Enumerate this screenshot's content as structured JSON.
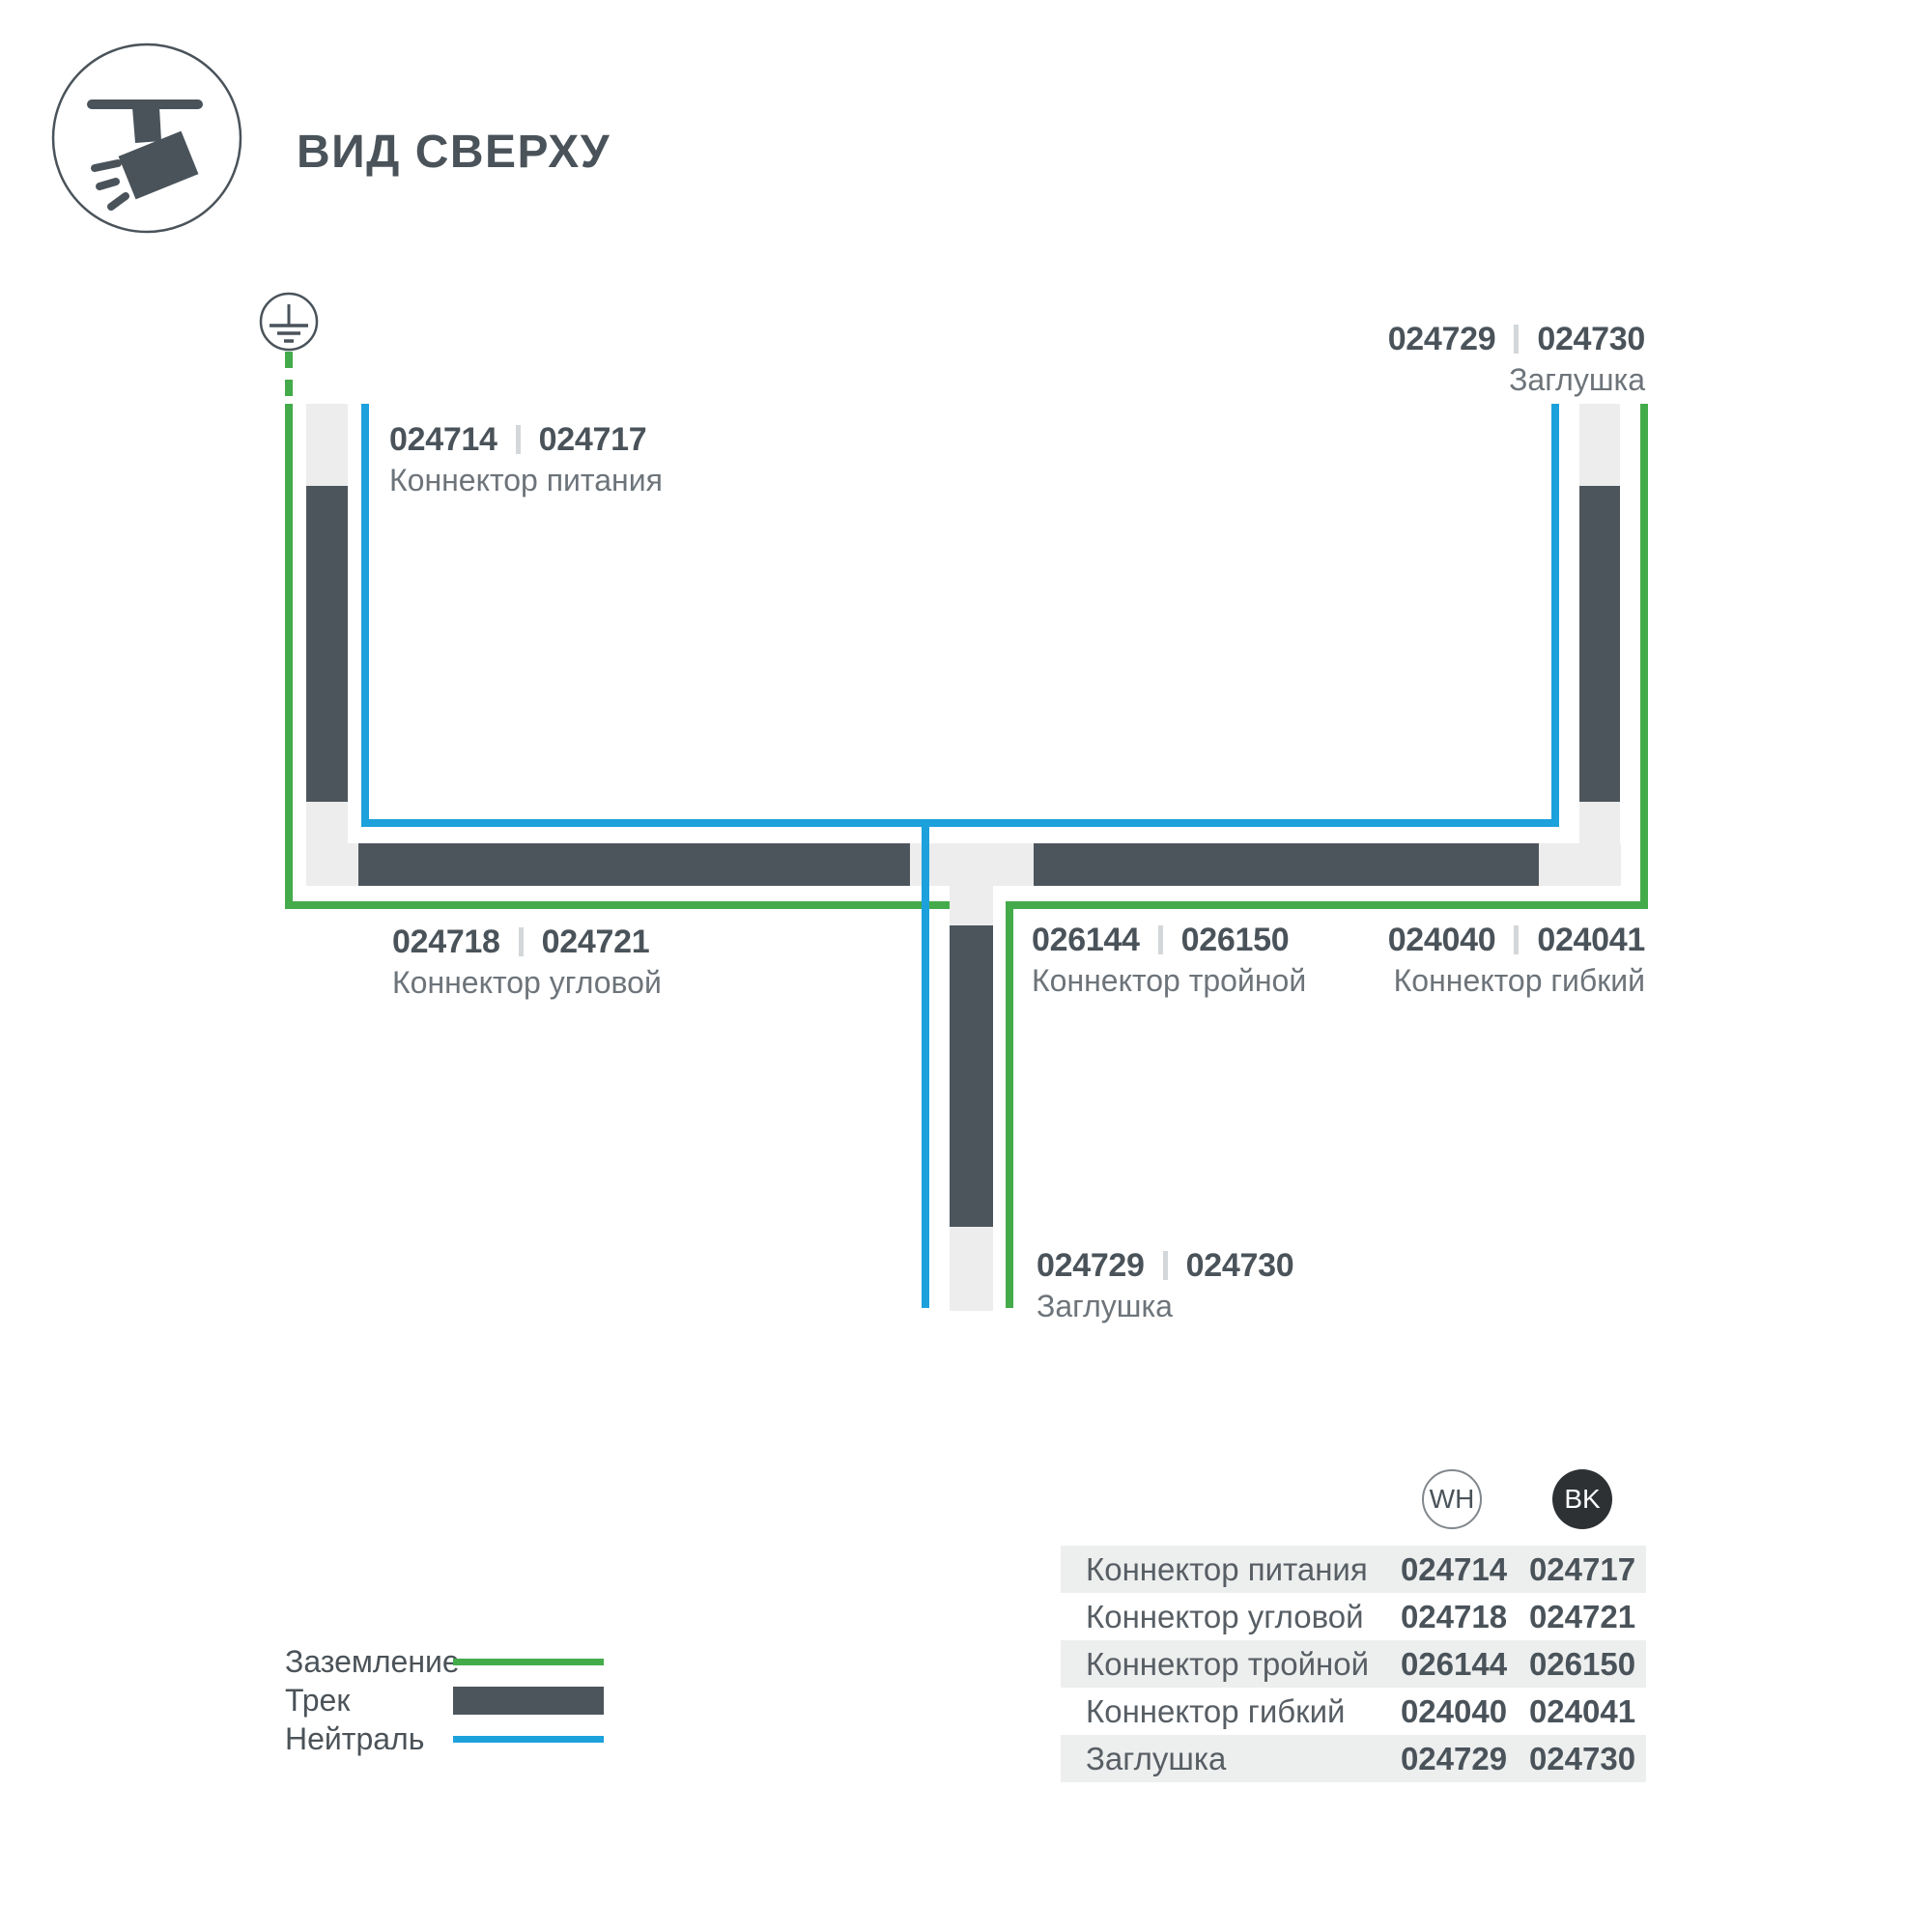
{
  "header": {
    "title": "ВИД СВЕРХУ"
  },
  "colors": {
    "dark_track": "#4d555c",
    "track_base": "#ecedec",
    "ground_green": "#44ab4a",
    "neutral_blue": "#1ca1dc",
    "label_code": "#4a535a",
    "label_name": "#6d747a",
    "table_band": "#edeeee",
    "bk_circle": "#2e3134"
  },
  "diagram": {
    "labels": {
      "power": {
        "code_wh": "024714",
        "code_bk": "024717",
        "name": "Коннектор питания"
      },
      "cap_top": {
        "code_wh": "024729",
        "code_bk": "024730",
        "name": "Заглушка"
      },
      "corner": {
        "code_wh": "024718",
        "code_bk": "024721",
        "name": "Коннектор угловой"
      },
      "triple": {
        "code_wh": "026144",
        "code_bk": "026150",
        "name": "Коннектор тройной"
      },
      "flexible": {
        "code_wh": "024040",
        "code_bk": "024041",
        "name": "Коннектор гибкий"
      },
      "cap_bottom": {
        "code_wh": "024729",
        "code_bk": "024730",
        "name": "Заглушка"
      }
    }
  },
  "legend": {
    "ground_label": "Заземление",
    "track_label": "Трек",
    "neutral_label": "Нейтраль"
  },
  "table": {
    "col_wh": "WH",
    "col_bk": "BK",
    "rows": [
      {
        "name": "Коннектор питания",
        "wh": "024714",
        "bk": "024717"
      },
      {
        "name": "Коннектор угловой",
        "wh": "024718",
        "bk": "024721"
      },
      {
        "name": "Коннектор тройной",
        "wh": "026144",
        "bk": "026150"
      },
      {
        "name": "Коннектор гибкий",
        "wh": "024040",
        "bk": "024041"
      },
      {
        "name": "Заглушка",
        "wh": "024729",
        "bk": "024730"
      }
    ]
  }
}
